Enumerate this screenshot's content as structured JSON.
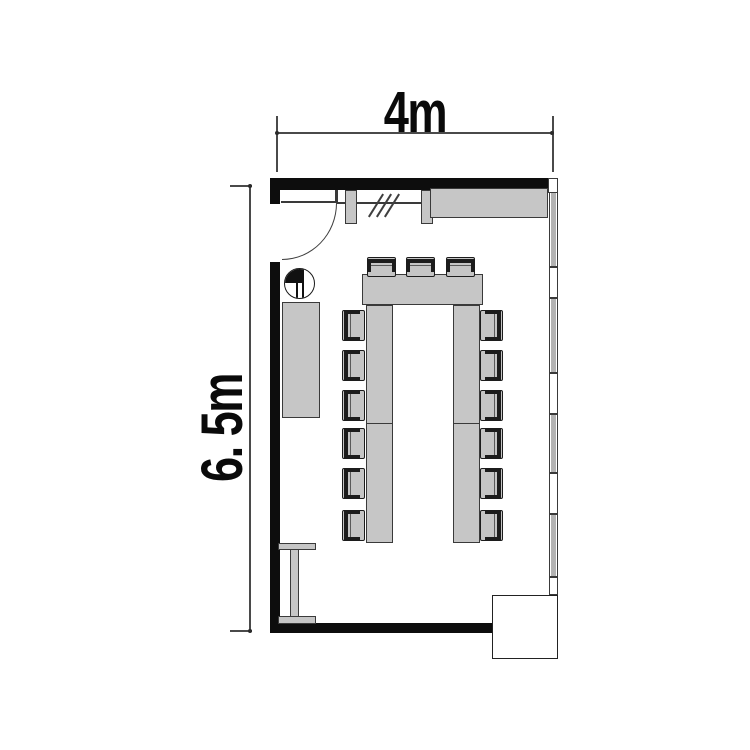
{
  "title": "Meeting room floor plan",
  "dimensions": {
    "width_label": "4m",
    "height_label": "6. 5m"
  },
  "furniture": {
    "table": "U-shaped conference table",
    "chairs": {
      "top": 3,
      "left": 6,
      "right": 6
    },
    "door": "hinged door at top-left, quarter-circle swing",
    "top_cabinet": "sideboard along top wall",
    "left_cabinet": "sideboard along left wall",
    "planter": "round planter/basin beside door",
    "side_table": "I-shaped side table at bottom-left",
    "corner_box": "column / duct enclosure at bottom-right",
    "glazing": "glass partition with hatch marks beside door"
  },
  "window_wall": {
    "description": "mullioned window wall on right side",
    "segments": [
      {
        "type": "pane",
        "h": 75
      },
      {
        "type": "gap",
        "h": 31
      },
      {
        "type": "pane",
        "h": 75
      },
      {
        "type": "gap",
        "h": 41
      },
      {
        "type": "pane",
        "h": 59
      },
      {
        "type": "gap",
        "h": 41
      },
      {
        "type": "pane",
        "h": 63
      },
      {
        "type": "gap",
        "h": 18
      }
    ]
  },
  "colors": {
    "wall": "#0d0d0d",
    "furniture_fill": "#c6c6c6",
    "outline": "#3a3a3a",
    "dimension": "#4a4a4a",
    "background": "#ffffff"
  }
}
